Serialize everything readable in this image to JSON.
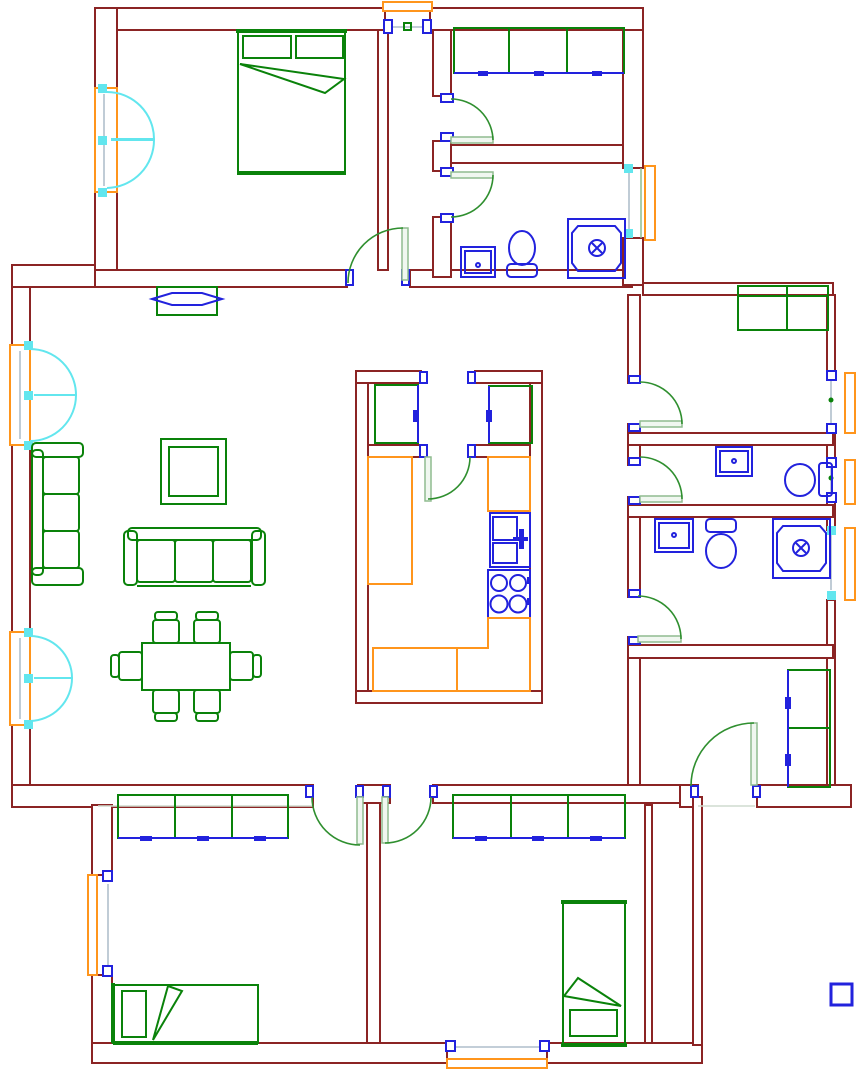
{
  "document": {
    "type": "architectural-floor-plan",
    "style": "CAD line drawing, no text labels",
    "background": "#ffffff"
  },
  "palette": {
    "wall": "#8b2424",
    "furniture": "#0a820a",
    "door_arc": "#2f8f2f",
    "door_leaf_fill": "#f0f7f0",
    "door_leaf_stroke": "#8fbc8f",
    "fixture": "#2222dd",
    "window_frame": "#ff951c",
    "counter": "#ff951c",
    "window_casement": "#62e6ee",
    "glass": "#9fb0c0",
    "threshold": "#cfdccf"
  },
  "rooms": [
    {
      "name": "master-bedroom",
      "position": "top-left",
      "items": [
        "double-bed",
        "casement-window",
        "swing-door"
      ]
    },
    {
      "name": "entry-corridor",
      "position": "top-center",
      "items": [
        "entrance-opening"
      ]
    },
    {
      "name": "closet-room",
      "position": "top-right",
      "items": [
        "wardrobe-3-section",
        "swing-door"
      ]
    },
    {
      "name": "bathroom-top",
      "position": "top-right",
      "items": [
        "sink",
        "toilet",
        "shower",
        "window",
        "swing-door"
      ]
    },
    {
      "name": "living-dining-room",
      "position": "center-left",
      "items": [
        "tv-console",
        "sofa-3-seat-vertical",
        "sofa-3-seat-horizontal",
        "coffee-table",
        "dining-table-6-chairs",
        "casement-window",
        "casement-window"
      ]
    },
    {
      "name": "kitchen",
      "position": "center",
      "items": [
        "tall-cabinet-left",
        "tall-cabinet-right",
        "counter-left",
        "counter-right",
        "double-sink",
        "stove-4-burners",
        "counter-bottom",
        "swing-door"
      ]
    },
    {
      "name": "study-room",
      "position": "right",
      "items": [
        "cabinet",
        "window",
        "swing-door"
      ]
    },
    {
      "name": "wc",
      "position": "right",
      "items": [
        "sink",
        "toilet",
        "window",
        "swing-door"
      ]
    },
    {
      "name": "bathroom-2",
      "position": "right",
      "items": [
        "sink",
        "toilet",
        "shower",
        "window",
        "swing-door"
      ]
    },
    {
      "name": "storage-room",
      "position": "bottom-right",
      "items": [
        "cabinet-2-section",
        "swing-door"
      ]
    },
    {
      "name": "bedroom-2",
      "position": "bottom-left",
      "items": [
        "wardrobe-3-section",
        "single-bed",
        "window",
        "swing-door"
      ]
    },
    {
      "name": "bedroom-3",
      "position": "bottom-center",
      "items": [
        "wardrobe-3-section",
        "single-bed",
        "window",
        "swing-door"
      ]
    }
  ],
  "legend": {
    "marker": "small-blue-square",
    "position": "bottom-right-outside-plan"
  }
}
